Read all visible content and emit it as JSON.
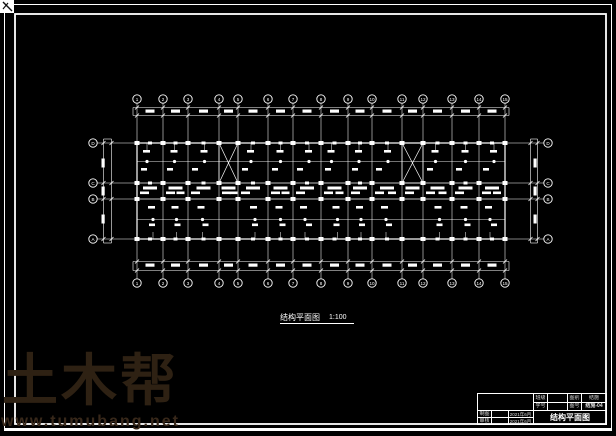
{
  "sheet": {
    "background": "#000000",
    "line_color": "#ffffff"
  },
  "watermark": {
    "logo": "土木帮",
    "url": "www.tumubang.net",
    "color": "#2e2113",
    "url_color": "#38281a"
  },
  "caption": {
    "title": "结构平面图",
    "scale": "1:100"
  },
  "grid": {
    "top_labels": [
      "1",
      "2",
      "3",
      "4",
      "5",
      "6",
      "7",
      "8",
      "9",
      "10",
      "11",
      "12",
      "13",
      "14",
      "15"
    ],
    "bottom_labels": [
      "1",
      "2",
      "3",
      "4",
      "5",
      "6",
      "7",
      "8",
      "9",
      "10",
      "11",
      "12",
      "13",
      "14",
      "15"
    ],
    "left_labels": [
      "D",
      "C",
      "B",
      "A"
    ],
    "right_labels": [
      "D",
      "C",
      "B",
      "A"
    ]
  },
  "plan": {
    "col_axes_x": [
      137,
      163,
      188,
      219,
      238,
      268,
      293,
      321,
      348,
      372,
      402,
      423,
      452,
      479,
      505
    ],
    "row_axes_y": [
      143,
      183,
      199,
      239
    ],
    "extent": {
      "left": 137,
      "right": 505,
      "top": 143,
      "bottom": 239
    },
    "top_bubble_y": 99,
    "bottom_bubble_y": 283,
    "left_bubble_x": 93,
    "right_bubble_x": 548,
    "stairwells": [
      {
        "x1": 219,
        "x2": 238,
        "y1": 143,
        "y2": 183
      },
      {
        "x1": 402,
        "x2": 423,
        "y1": 143,
        "y2": 183
      }
    ]
  },
  "title_block": {
    "class_label": "班级",
    "id_label": "学号",
    "cat_label": "图别",
    "cat_value": "结施",
    "no_label": "图号",
    "no_value": "结施-04",
    "draw_label": "制图",
    "draw_date": "2021年6月",
    "check_label": "审核",
    "check_date": "2021年6月",
    "drawing_title": "结构平面图"
  }
}
